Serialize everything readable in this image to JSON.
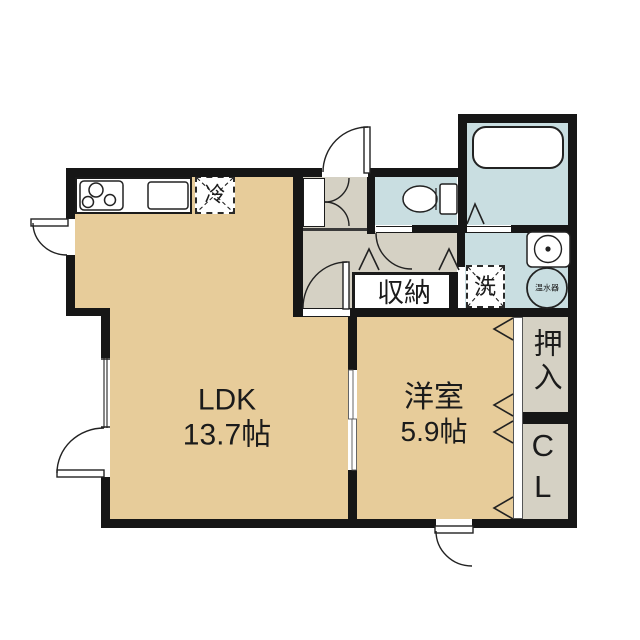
{
  "plan_title": "1LDK floor plan",
  "colors": {
    "wall": "#161616",
    "room": "#e7cc9a",
    "hall": "#d5d1c4",
    "wet": "#c9dee1"
  },
  "rooms": {
    "ldk": {
      "name": "LDK",
      "size": "13.7帖"
    },
    "western": {
      "name": "洋室",
      "size": "5.9帖"
    },
    "storage": {
      "label": "収納"
    },
    "oshiire": {
      "label": "押入"
    },
    "closet": {
      "label": "CL"
    }
  },
  "fixtures": {
    "refrigerator": {
      "label": "冷"
    },
    "washer": {
      "label": "洗"
    },
    "water_heater": {
      "label": "温水器"
    }
  }
}
